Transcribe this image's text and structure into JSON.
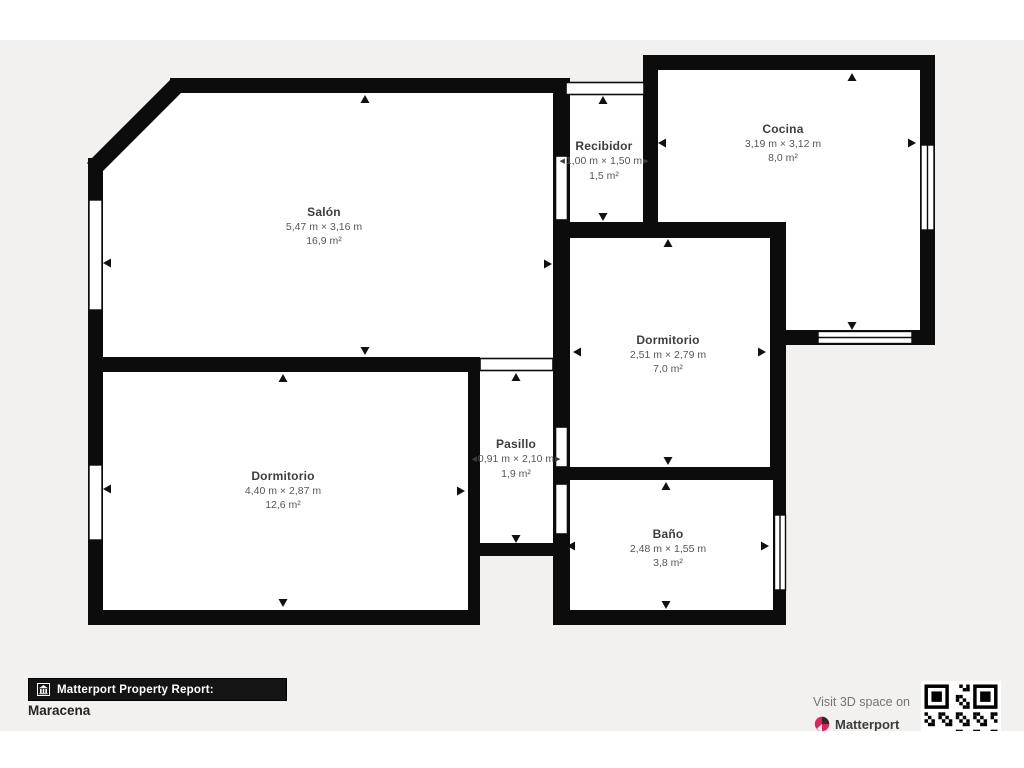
{
  "floorplan": {
    "rooms": [
      {
        "name": "Salón",
        "dims": "5,47 m × 3,16 m",
        "area": "16,9 m²"
      },
      {
        "name": "Recibidor",
        "dims": "1,00 m × 1,50 m",
        "area": "1,5 m²"
      },
      {
        "name": "Cocina",
        "dims": "3,19 m × 3,12 m",
        "area": "8,0 m²"
      },
      {
        "name": "Dormitorio",
        "dims": "2,51 m × 2,79 m",
        "area": "7,0 m²"
      },
      {
        "name": "Pasillo",
        "dims": "0,91 m × 2,10 m",
        "area": "1,9 m²"
      },
      {
        "name": "Dormitorio",
        "dims": "4,40 m × 2,87 m",
        "area": "12,6 m²"
      },
      {
        "name": "Baño",
        "dims": "2,48 m × 1,55 m",
        "area": "3,8 m²"
      }
    ]
  },
  "footer": {
    "report_label": "Matterport Property Report:",
    "property_name": "Maracena",
    "visit_text": "Visit 3D space on",
    "brand_name": "Matterport"
  },
  "icons": {
    "dim_arrow_left": "◀",
    "dim_arrow_right": "▶"
  },
  "colors": {
    "wall": "#0c0c0c",
    "canvas_bg": "#f2f1ef",
    "brand_pink": "#e61e5c"
  }
}
